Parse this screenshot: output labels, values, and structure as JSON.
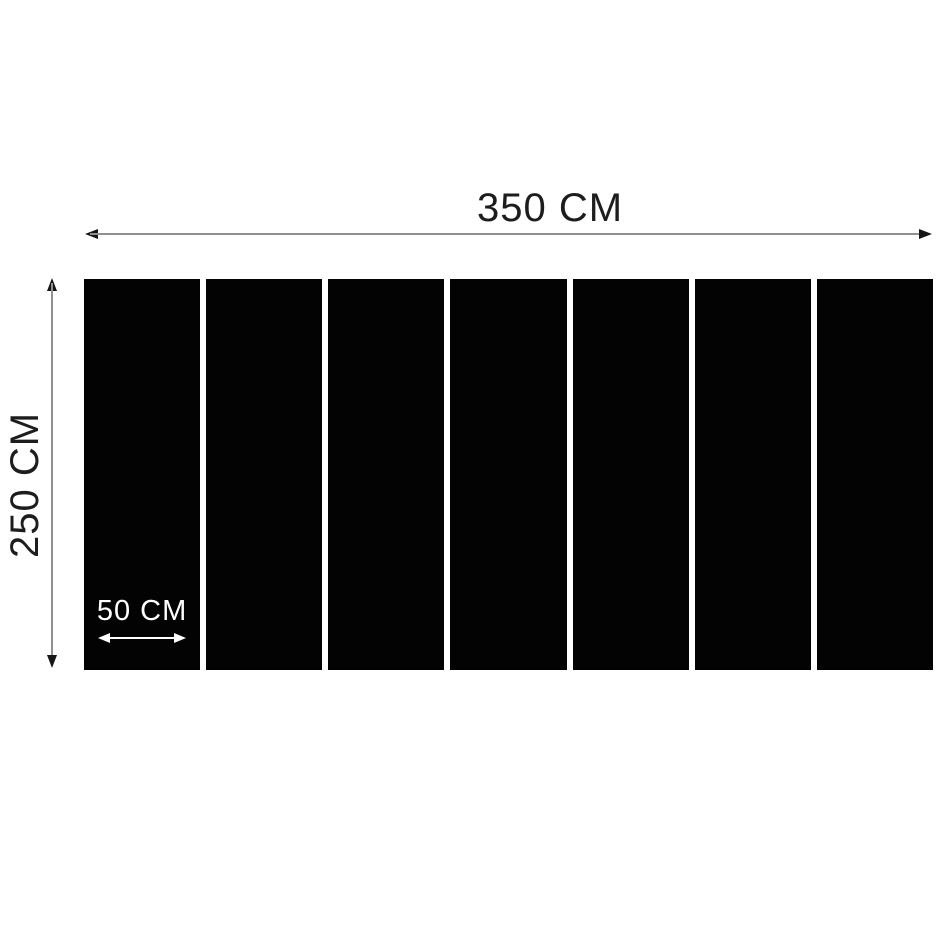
{
  "dimensions": {
    "width": {
      "label": "350 CM"
    },
    "height": {
      "label": "250 CM"
    },
    "panel_width": {
      "label": "50 CM"
    }
  },
  "panels": {
    "count": 7,
    "color": "#030303"
  },
  "colors": {
    "background": "#ffffff",
    "dimension_line": "#909090",
    "arrowhead": "#161616",
    "text": "#1d1d1d",
    "panel_annotation": "#ffffff"
  }
}
